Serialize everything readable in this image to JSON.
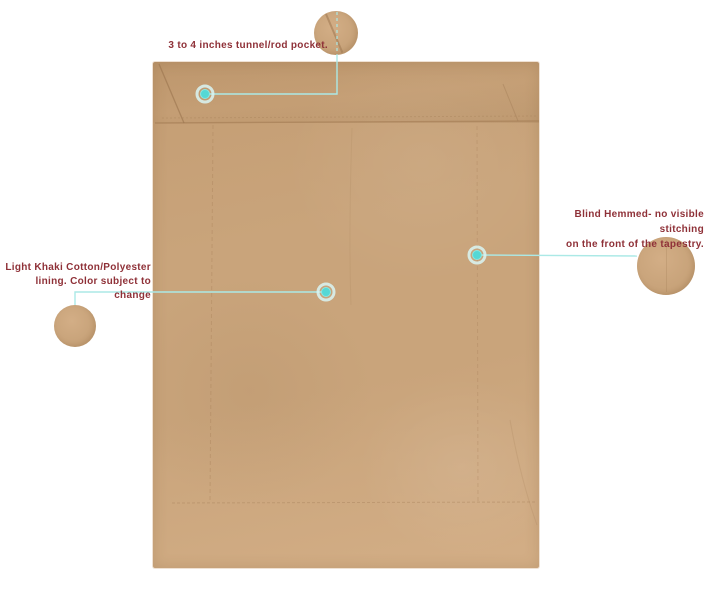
{
  "colors": {
    "background": "#ffffff",
    "fabric-base": "#c9a47b",
    "fabric-flap": "#c49d73",
    "fabric-light": "#d3ae86",
    "seam": "#a8815a",
    "crease": "#9c7650",
    "callout-line": "#abe9e6",
    "callout-dot": "#55d8d5",
    "callout-dot-ring": "#d9f6f4",
    "label-text": "#8f3138"
  },
  "annotations": {
    "rod_pocket": {
      "text": "3 to 4 inches tunnel/rod pocket."
    },
    "blind_hem": {
      "line1": "Blind Hemmed- no visible stitching",
      "line2": "on the front of the tapestry."
    },
    "lining": {
      "line1": "Light Khaki Cotton/Polyester",
      "line2": "lining. Color subject to change"
    }
  }
}
